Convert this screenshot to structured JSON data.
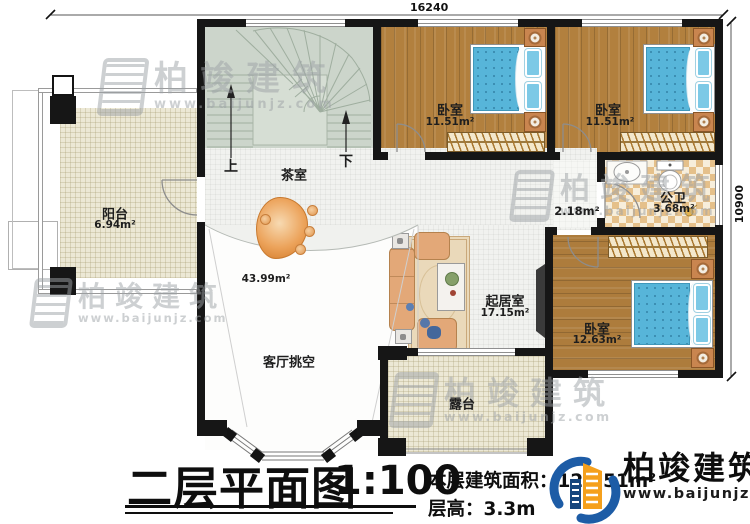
{
  "title": {
    "main": "二层平面图",
    "scale": "1:100"
  },
  "info": {
    "area_label": "本层建筑面积：",
    "area_value": "127.51m²",
    "height_label": "层高：",
    "height_value": "3.3m"
  },
  "dims": {
    "top": "16240",
    "right": "10900"
  },
  "stairs": {
    "up": "上",
    "down": "下"
  },
  "rooms": {
    "balcony": {
      "name": "阳台",
      "area": "6.94m²"
    },
    "tea_room": {
      "name": "茶室"
    },
    "bedroom1": {
      "name": "卧室",
      "area": "11.51m²"
    },
    "bedroom2": {
      "name": "卧室",
      "area": "11.51m²"
    },
    "hall": {
      "area": "2.18m²"
    },
    "bathroom": {
      "name": "公卫",
      "area": "3.68m²"
    },
    "bedroom3": {
      "name": "卧室",
      "area": "12.63m²"
    },
    "living_room": {
      "name": "起居室",
      "area": "17.15m²"
    },
    "void": {
      "name": "客厅挑空",
      "area": "43.99m²"
    },
    "terrace": {
      "name": "露台"
    }
  },
  "brand": {
    "name": "柏竣建筑",
    "tick": "`",
    "url": "www.baijunjz.com"
  },
  "watermark": {
    "name": "柏竣建筑",
    "url": "www.baijunjz.com"
  },
  "colors": {
    "wall": "#161616",
    "wood": "#b2803e",
    "bed_blue": "#57b5d9",
    "floor_cream": "#ece8d5",
    "bath_tile": "#e5c08a",
    "brand_blue": "#1d5ca6",
    "brand_orange": "#f5a01c"
  }
}
